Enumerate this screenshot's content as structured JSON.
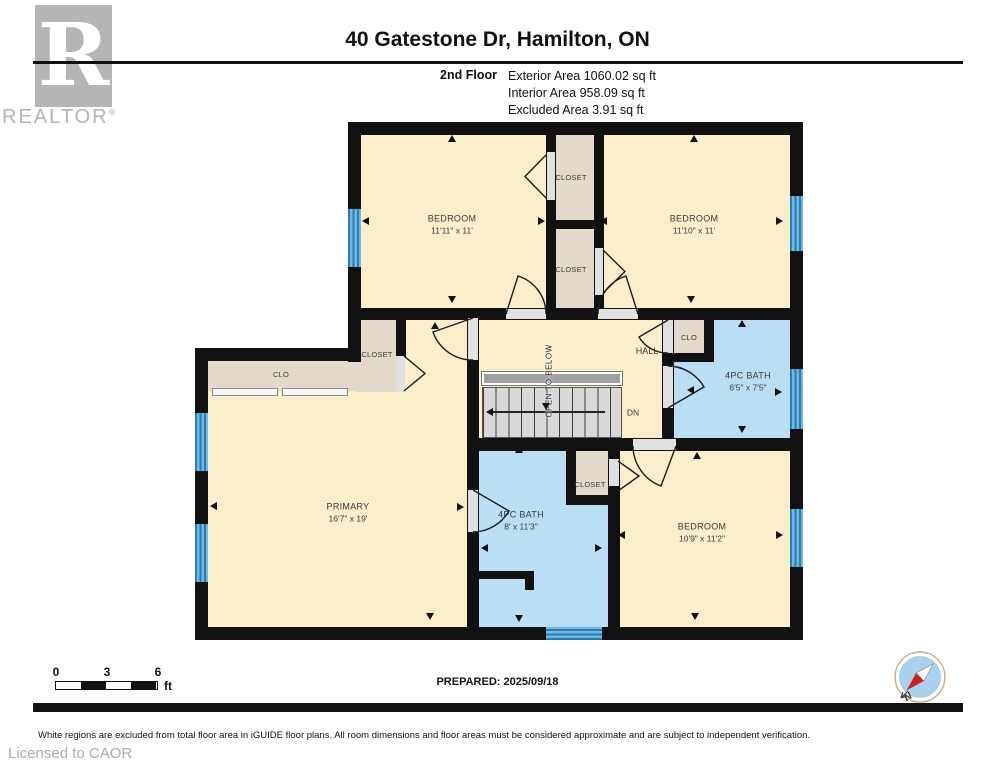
{
  "header": {
    "logo": {
      "letter": "R",
      "brand": "REALTOR",
      "registered": "®"
    },
    "title": "40 Gatestone Dr, Hamilton, ON",
    "floor_label": "2nd Floor",
    "areas": [
      "Exterior Area 1060.02 sq ft",
      "Interior Area 958.09 sq ft",
      "Excluded Area 3.91 sq ft"
    ]
  },
  "plan": {
    "rooms": {
      "bedroom1": {
        "name": "BEDROOM",
        "dims": "11'11\" x 11'"
      },
      "bedroom2": {
        "name": "BEDROOM",
        "dims": "11'10\" x 11'"
      },
      "bedroom3": {
        "name": "BEDROOM",
        "dims": "10'9\" x 11'2\""
      },
      "primary": {
        "name": "PRIMARY",
        "dims": "16'7\" x 19'"
      },
      "bath_hall": {
        "name": "4PC BATH",
        "dims": "6'5\" x 7'5\""
      },
      "bath_primary": {
        "name": "4PC BATH",
        "dims": "8' x 11'3\""
      },
      "hall": {
        "name": "HALL"
      }
    },
    "closets": {
      "closet_top": "CLOSET",
      "closet_mid": "CLOSET",
      "closet_left": "CLOSET",
      "closet_bath": "CLOSET",
      "clo_long": "CLO",
      "clo_hall": "CLO"
    },
    "stairs": {
      "open_to_below": "OPEN TO BELOW",
      "down": "DN"
    }
  },
  "footer": {
    "scale": {
      "t0": "0",
      "t3": "3",
      "t6": "6",
      "unit": "ft"
    },
    "prepared": "PREPARED: 2025/09/18",
    "compass_n": "N",
    "disclaimer": "White regions are excluded from total floor area in iGUIDE floor plans. All room dimensions and floor areas must be considered approximate and are subject to independent verification.",
    "licensed": "Licensed to CAOR"
  },
  "colors": {
    "room_fill": "#FAEECB",
    "closet_fill": "#E2D9CA",
    "bath_fill": "#BADFF5",
    "window_blue": "#3D93C8",
    "wall": "#111111"
  }
}
